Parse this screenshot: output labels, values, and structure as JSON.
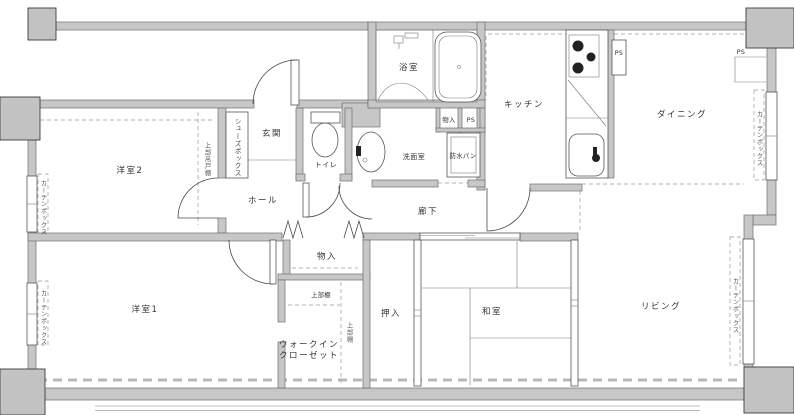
{
  "drawing": {
    "type": "apartment-floor-plan",
    "style": "japanese-madori"
  },
  "labels": {
    "bedroom2": "洋室2",
    "bedroom1": "洋室1",
    "entrance": "玄関",
    "hall": "ホール",
    "toilet": "トイレ",
    "washroom": "洗面室",
    "waterproof_pan": "防水パン",
    "bathroom": "浴室",
    "kitchen": "キッチン",
    "dining": "ダイニング",
    "corridor": "廊下",
    "storage_corridor": "物入",
    "storage_bath": "物入",
    "closet": "押入",
    "japanese_room": "和室",
    "living": "リビング",
    "wic_line1": "ウォークイン",
    "wic_line2": "クローゼット",
    "upper_shelf": "上部棚",
    "upper_shelf_vertical": "上部棚",
    "shoe_box": "シューズボックス",
    "upper_hanging_cabinet": "上部吊戸棚",
    "curtain_box": "カーテンボックス",
    "ps": "PS"
  },
  "colors": {
    "wall_fill": "#c7c7c7",
    "wall_stroke": "#6e6e6e",
    "block_fill": "#c2c2c2",
    "line": "#4a4a4a",
    "dash": "#999999",
    "text": "#333333",
    "background": "#ffffff"
  }
}
